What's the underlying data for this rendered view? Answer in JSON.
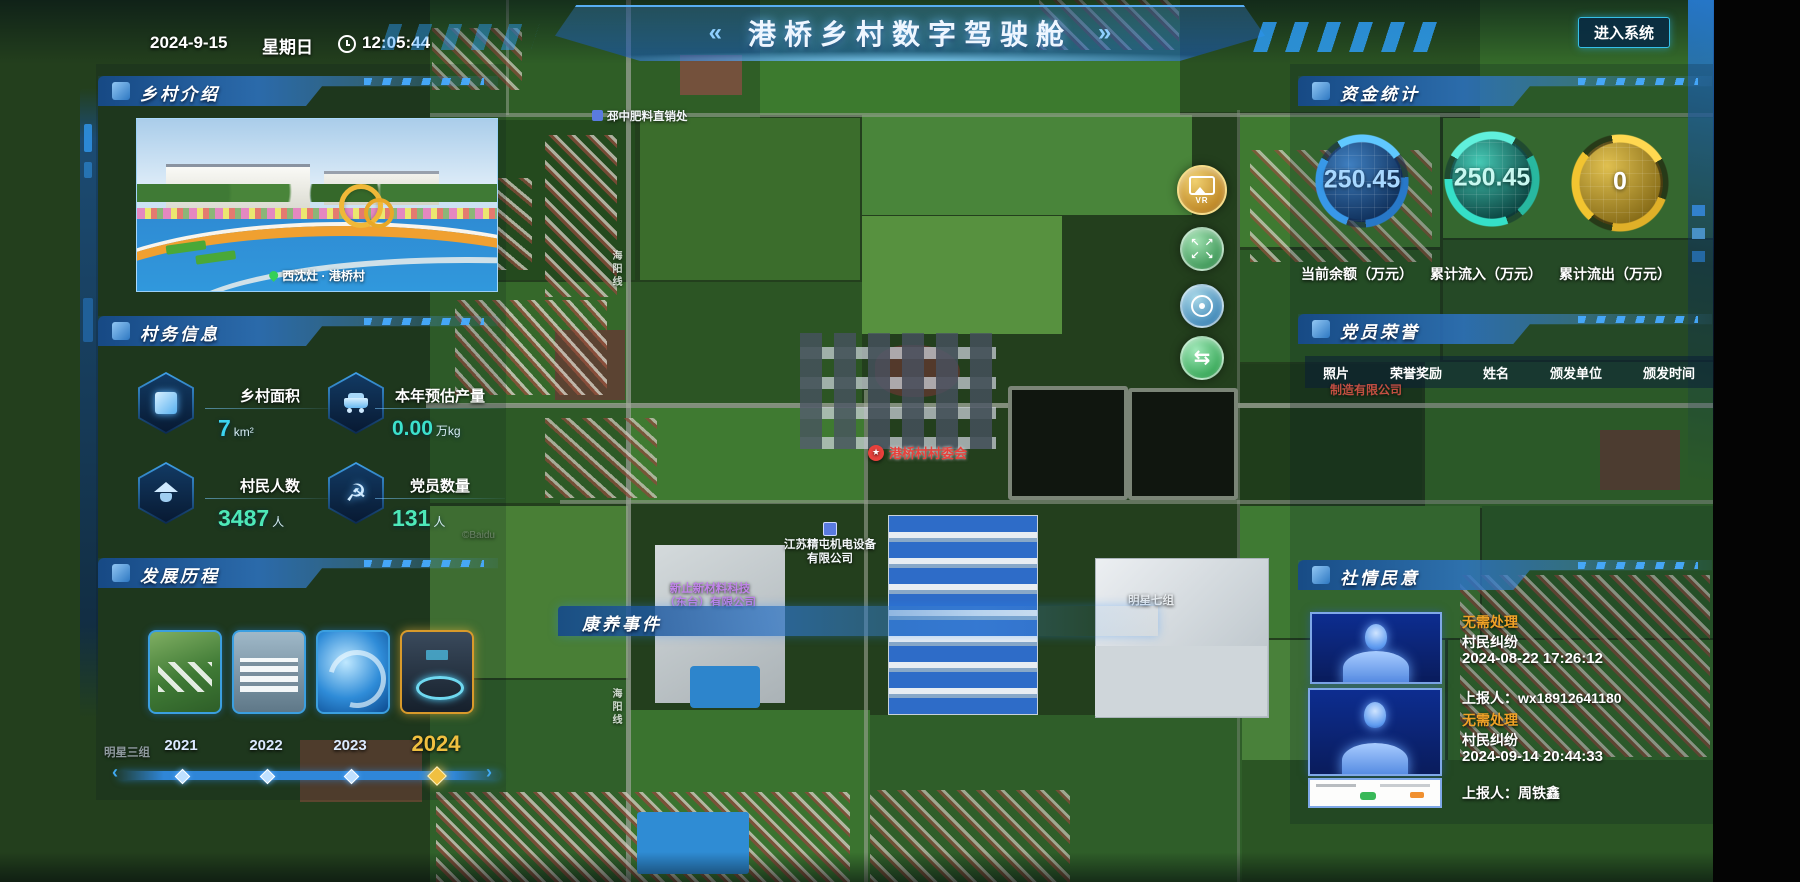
{
  "header": {
    "date": "2024-9-15",
    "weekday": "星期日",
    "time": "12:05:44",
    "title": "港桥乡村数字驾驶舱",
    "title_left_mark": "«",
    "title_right_mark": "»",
    "enter_button": "进入系统"
  },
  "panels": {
    "village_intro": {
      "title": "乡村介绍",
      "photo_caption": "西沈灶 · 港桥村"
    },
    "village_info": {
      "title": "村务信息",
      "stats": [
        {
          "label": "乡村面积",
          "value": "7",
          "unit": "km²"
        },
        {
          "label": "本年预估产量",
          "value": "0.00",
          "unit": "万kg"
        },
        {
          "label": "村民人数",
          "value": "3487",
          "unit": "人"
        },
        {
          "label": "党员数量",
          "value": "131",
          "unit": "人"
        }
      ]
    },
    "development": {
      "title": "发展历程",
      "years": [
        "2021",
        "2022",
        "2023",
        "2024"
      ],
      "selected_year": "2024"
    },
    "funds": {
      "title": "资金统计",
      "gauges": [
        {
          "value": "250.45",
          "label": "当前余额（万元）",
          "color": "#4da3ff"
        },
        {
          "value": "250.45",
          "label": "累计流入（万元）",
          "color": "#35e0c8"
        },
        {
          "value": "0",
          "label": "累计流出（万元）",
          "color": "#f2c430"
        }
      ]
    },
    "party_honor": {
      "title": "党员荣誉",
      "columns": [
        "照片",
        "荣誉奖励",
        "姓名",
        "颁发单位",
        "颁发时间"
      ],
      "partial_map_label": "制造有限公司"
    },
    "sentiment": {
      "title": "社情民意",
      "items": [
        {
          "status": "无需处理",
          "type": "村民纠纷",
          "time": "2024-08-22 17:26:12",
          "reporter": "上报人：wx18912641180"
        },
        {
          "status": "无需处理",
          "type": "村民纠纷",
          "time": "2024-09-14 20:44:33",
          "reporter": "上报人：周铁鑫"
        }
      ]
    },
    "health": {
      "title": "康养事件"
    }
  },
  "map": {
    "labels": {
      "fertilizer": "邳中肥料直销处",
      "committee": "港桥村村委会",
      "company1_line1": "江苏精屯机电设备",
      "company1_line2": "有限公司",
      "company2_line1": "新止新材料科技",
      "company2_line2": "（东台）有限公司",
      "group7": "明星七组",
      "group3": "明星三组",
      "road_top": "海阳线",
      "road_bottom": "海阳线",
      "watermark": "©Baidu"
    },
    "tools": {
      "vr": "VR"
    }
  }
}
